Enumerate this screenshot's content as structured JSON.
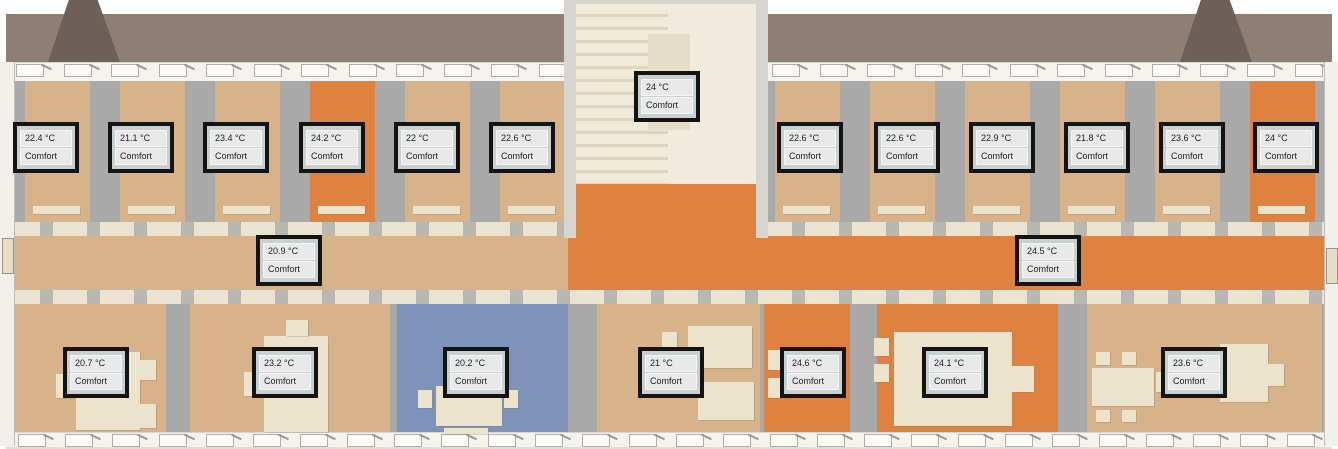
{
  "view": {
    "description": "3D building floor plan with room temperature sensors",
    "status_label": "Comfort"
  },
  "colors": {
    "tan": "#d8b289",
    "orange": "#e0823f",
    "blue": "#7e93b9",
    "cream": "#ece3cd",
    "wall_gray": "#a9a9a9",
    "roof": "#8f7e74",
    "roof_dark": "#6e5f58",
    "badge_border": "#141414",
    "badge_cell": "#e9e9e9"
  },
  "sensors": [
    {
      "temp": "22.4 °C",
      "status": "Comfort",
      "x": 13,
      "y": 122
    },
    {
      "temp": "21.1 °C",
      "status": "Comfort",
      "x": 108,
      "y": 122
    },
    {
      "temp": "23.4 °C",
      "status": "Comfort",
      "x": 203,
      "y": 122
    },
    {
      "temp": "24.2 °C",
      "status": "Comfort",
      "x": 299,
      "y": 122
    },
    {
      "temp": "22 °C",
      "status": "Comfort",
      "x": 394,
      "y": 122
    },
    {
      "temp": "22.6 °C",
      "status": "Comfort",
      "x": 489,
      "y": 122
    },
    {
      "temp": "24 °C",
      "status": "Comfort",
      "x": 634,
      "y": 71
    },
    {
      "temp": "22.6 °C",
      "status": "Comfort",
      "x": 777,
      "y": 122
    },
    {
      "temp": "22.6 °C",
      "status": "Comfort",
      "x": 874,
      "y": 122
    },
    {
      "temp": "22.9 °C",
      "status": "Comfort",
      "x": 969,
      "y": 122
    },
    {
      "temp": "21.8 °C",
      "status": "Comfort",
      "x": 1064,
      "y": 122
    },
    {
      "temp": "23.6 °C",
      "status": "Comfort",
      "x": 1159,
      "y": 122
    },
    {
      "temp": "24 °C",
      "status": "Comfort",
      "x": 1253,
      "y": 122
    },
    {
      "temp": "20.9 °C",
      "status": "Comfort",
      "x": 256,
      "y": 235
    },
    {
      "temp": "24.5 °C",
      "status": "Comfort",
      "x": 1015,
      "y": 235
    },
    {
      "temp": "20.7 °C",
      "status": "Comfort",
      "x": 63,
      "y": 347
    },
    {
      "temp": "23.2 °C",
      "status": "Comfort",
      "x": 252,
      "y": 347
    },
    {
      "temp": "20.2 °C",
      "status": "Comfort",
      "x": 443,
      "y": 347
    },
    {
      "temp": "21 °C",
      "status": "Comfort",
      "x": 638,
      "y": 347
    },
    {
      "temp": "24.6 °C",
      "status": "Comfort",
      "x": 780,
      "y": 347
    },
    {
      "temp": "24.1 °C",
      "status": "Comfort",
      "x": 922,
      "y": 347
    },
    {
      "temp": "23.6 °C",
      "status": "Comfort",
      "x": 1161,
      "y": 347
    }
  ],
  "scene": {
    "top_rooms": [
      {
        "x": 25,
        "w": 65,
        "color": "tan"
      },
      {
        "x": 120,
        "w": 65,
        "color": "tan"
      },
      {
        "x": 215,
        "w": 65,
        "color": "tan"
      },
      {
        "x": 310,
        "w": 65,
        "color": "orange"
      },
      {
        "x": 405,
        "w": 65,
        "color": "tan"
      },
      {
        "x": 500,
        "w": 65,
        "color": "tan"
      },
      {
        "x": 775,
        "w": 65,
        "color": "tan"
      },
      {
        "x": 870,
        "w": 65,
        "color": "tan"
      },
      {
        "x": 965,
        "w": 65,
        "color": "tan"
      },
      {
        "x": 1060,
        "w": 65,
        "color": "tan"
      },
      {
        "x": 1155,
        "w": 65,
        "color": "tan"
      },
      {
        "x": 1250,
        "w": 65,
        "color": "orange"
      }
    ],
    "bottom_rooms": [
      {
        "x": 14,
        "w": 152,
        "color": "tan"
      },
      {
        "x": 190,
        "w": 200,
        "color": "tan"
      },
      {
        "x": 397,
        "w": 171,
        "color": "blue"
      },
      {
        "x": 597,
        "w": 163,
        "color": "tan"
      },
      {
        "x": 764,
        "w": 86,
        "color": "orange"
      },
      {
        "x": 877,
        "w": 181,
        "color": "orange"
      },
      {
        "x": 1087,
        "w": 235,
        "color": "tan"
      }
    ],
    "corridor": [
      {
        "x": 6,
        "w": 562,
        "color": "tan"
      },
      {
        "x": 568,
        "w": 764,
        "color": "orange"
      }
    ],
    "furniture": [
      {
        "x": 76,
        "y": 352,
        "w": 64,
        "h": 78
      },
      {
        "x": 56,
        "y": 374,
        "w": 18,
        "h": 24
      },
      {
        "x": 140,
        "y": 360,
        "w": 16,
        "h": 20
      },
      {
        "x": 140,
        "y": 404,
        "w": 16,
        "h": 24
      },
      {
        "x": 264,
        "y": 336,
        "w": 64,
        "h": 96
      },
      {
        "x": 244,
        "y": 372,
        "w": 18,
        "h": 24
      },
      {
        "x": 286,
        "y": 320,
        "w": 22,
        "h": 16
      },
      {
        "x": 436,
        "y": 386,
        "w": 66,
        "h": 40
      },
      {
        "x": 418,
        "y": 390,
        "w": 14,
        "h": 18
      },
      {
        "x": 504,
        "y": 390,
        "w": 14,
        "h": 18
      },
      {
        "x": 444,
        "y": 428,
        "w": 44,
        "h": 6
      },
      {
        "x": 688,
        "y": 326,
        "w": 64,
        "h": 42
      },
      {
        "x": 662,
        "y": 332,
        "w": 15,
        "h": 15
      },
      {
        "x": 662,
        "y": 354,
        "w": 15,
        "h": 15
      },
      {
        "x": 698,
        "y": 382,
        "w": 56,
        "h": 38
      },
      {
        "x": 768,
        "y": 350,
        "w": 20,
        "h": 20
      },
      {
        "x": 768,
        "y": 378,
        "w": 20,
        "h": 20
      },
      {
        "x": 894,
        "y": 332,
        "w": 118,
        "h": 94
      },
      {
        "x": 874,
        "y": 338,
        "w": 15,
        "h": 18
      },
      {
        "x": 874,
        "y": 364,
        "w": 15,
        "h": 18
      },
      {
        "x": 1012,
        "y": 366,
        "w": 22,
        "h": 26
      },
      {
        "x": 1096,
        "y": 352,
        "w": 14,
        "h": 13
      },
      {
        "x": 1122,
        "y": 352,
        "w": 14,
        "h": 13
      },
      {
        "x": 1092,
        "y": 368,
        "w": 62,
        "h": 38
      },
      {
        "x": 1096,
        "y": 410,
        "w": 14,
        "h": 12
      },
      {
        "x": 1122,
        "y": 410,
        "w": 14,
        "h": 12
      },
      {
        "x": 1156,
        "y": 372,
        "w": 14,
        "h": 20
      },
      {
        "x": 1220,
        "y": 344,
        "w": 48,
        "h": 58
      },
      {
        "x": 1268,
        "y": 364,
        "w": 16,
        "h": 22
      }
    ]
  }
}
